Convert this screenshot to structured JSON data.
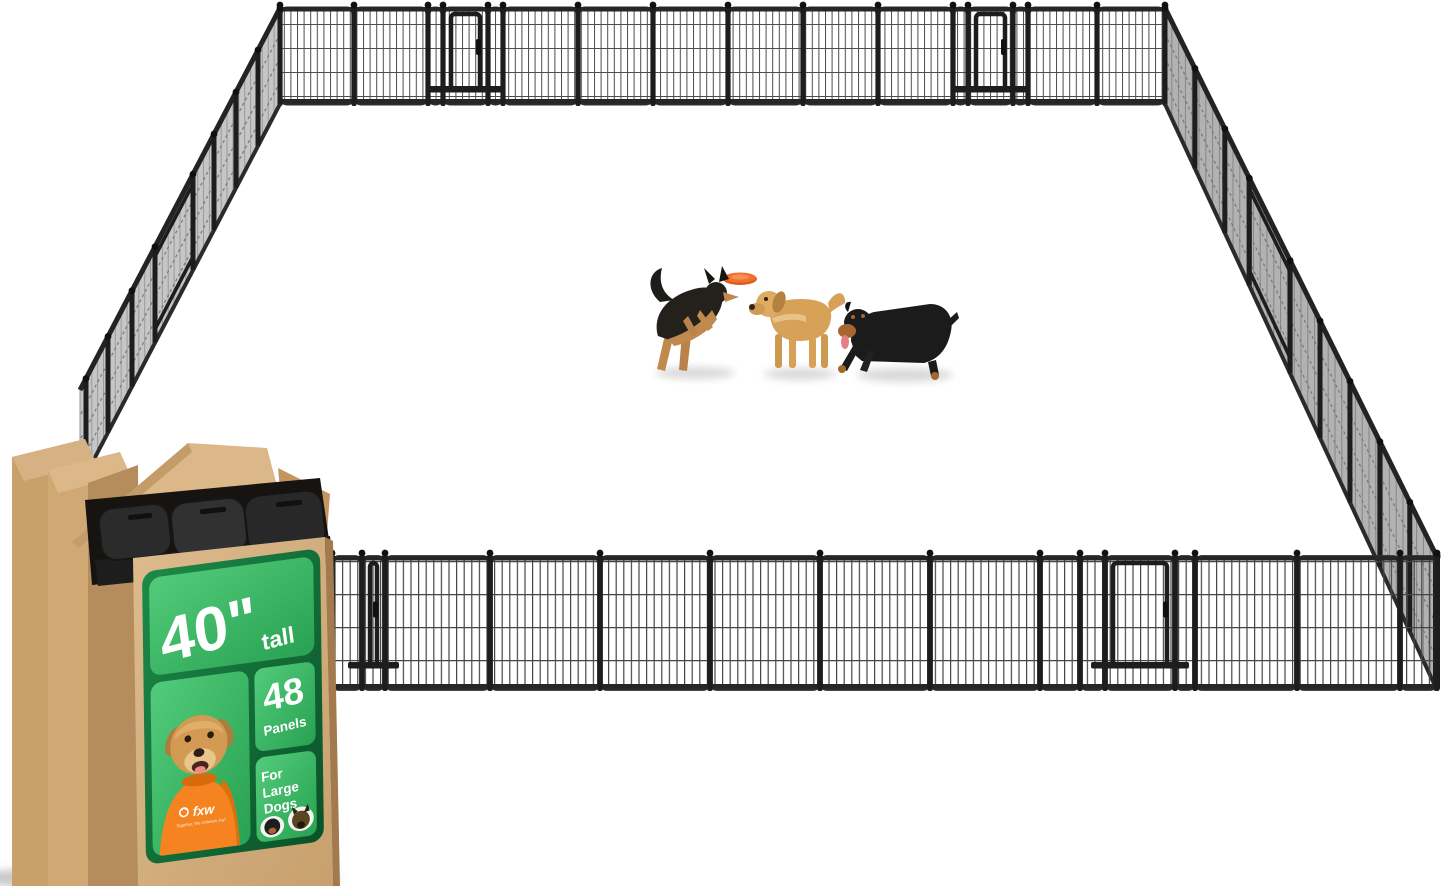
{
  "product_image": {
    "description": "Large outdoor dog playpen enclosure made of many metal wire panels, shown in perspective with three dogs playing with a frisbee inside, and the shipping box in the foreground corner",
    "box_label": {
      "height_value": "40\"",
      "height_unit": "tall",
      "panel_count": "48",
      "panel_count_label": "Panels",
      "audience_line1": "For",
      "audience_line2": "Large",
      "audience_line3": "Dogs",
      "brand": "fxw",
      "brand_tagline": "Together, We Unleash Joy!"
    },
    "scene": {
      "dog_left": "german-shepherd",
      "dog_center": "golden-retriever",
      "dog_right": "rottweiler",
      "toy": "orange-frisbee"
    },
    "colors": {
      "label_green_dark": "#0f6132",
      "label_green_bright": "#3cbd64",
      "cardboard": "#d4b084",
      "cardboard_shadow": "#b28a58",
      "fence_metal": "#262626",
      "shirt_orange": "#f5831f",
      "frisbee_orange": "#ee7130"
    }
  }
}
